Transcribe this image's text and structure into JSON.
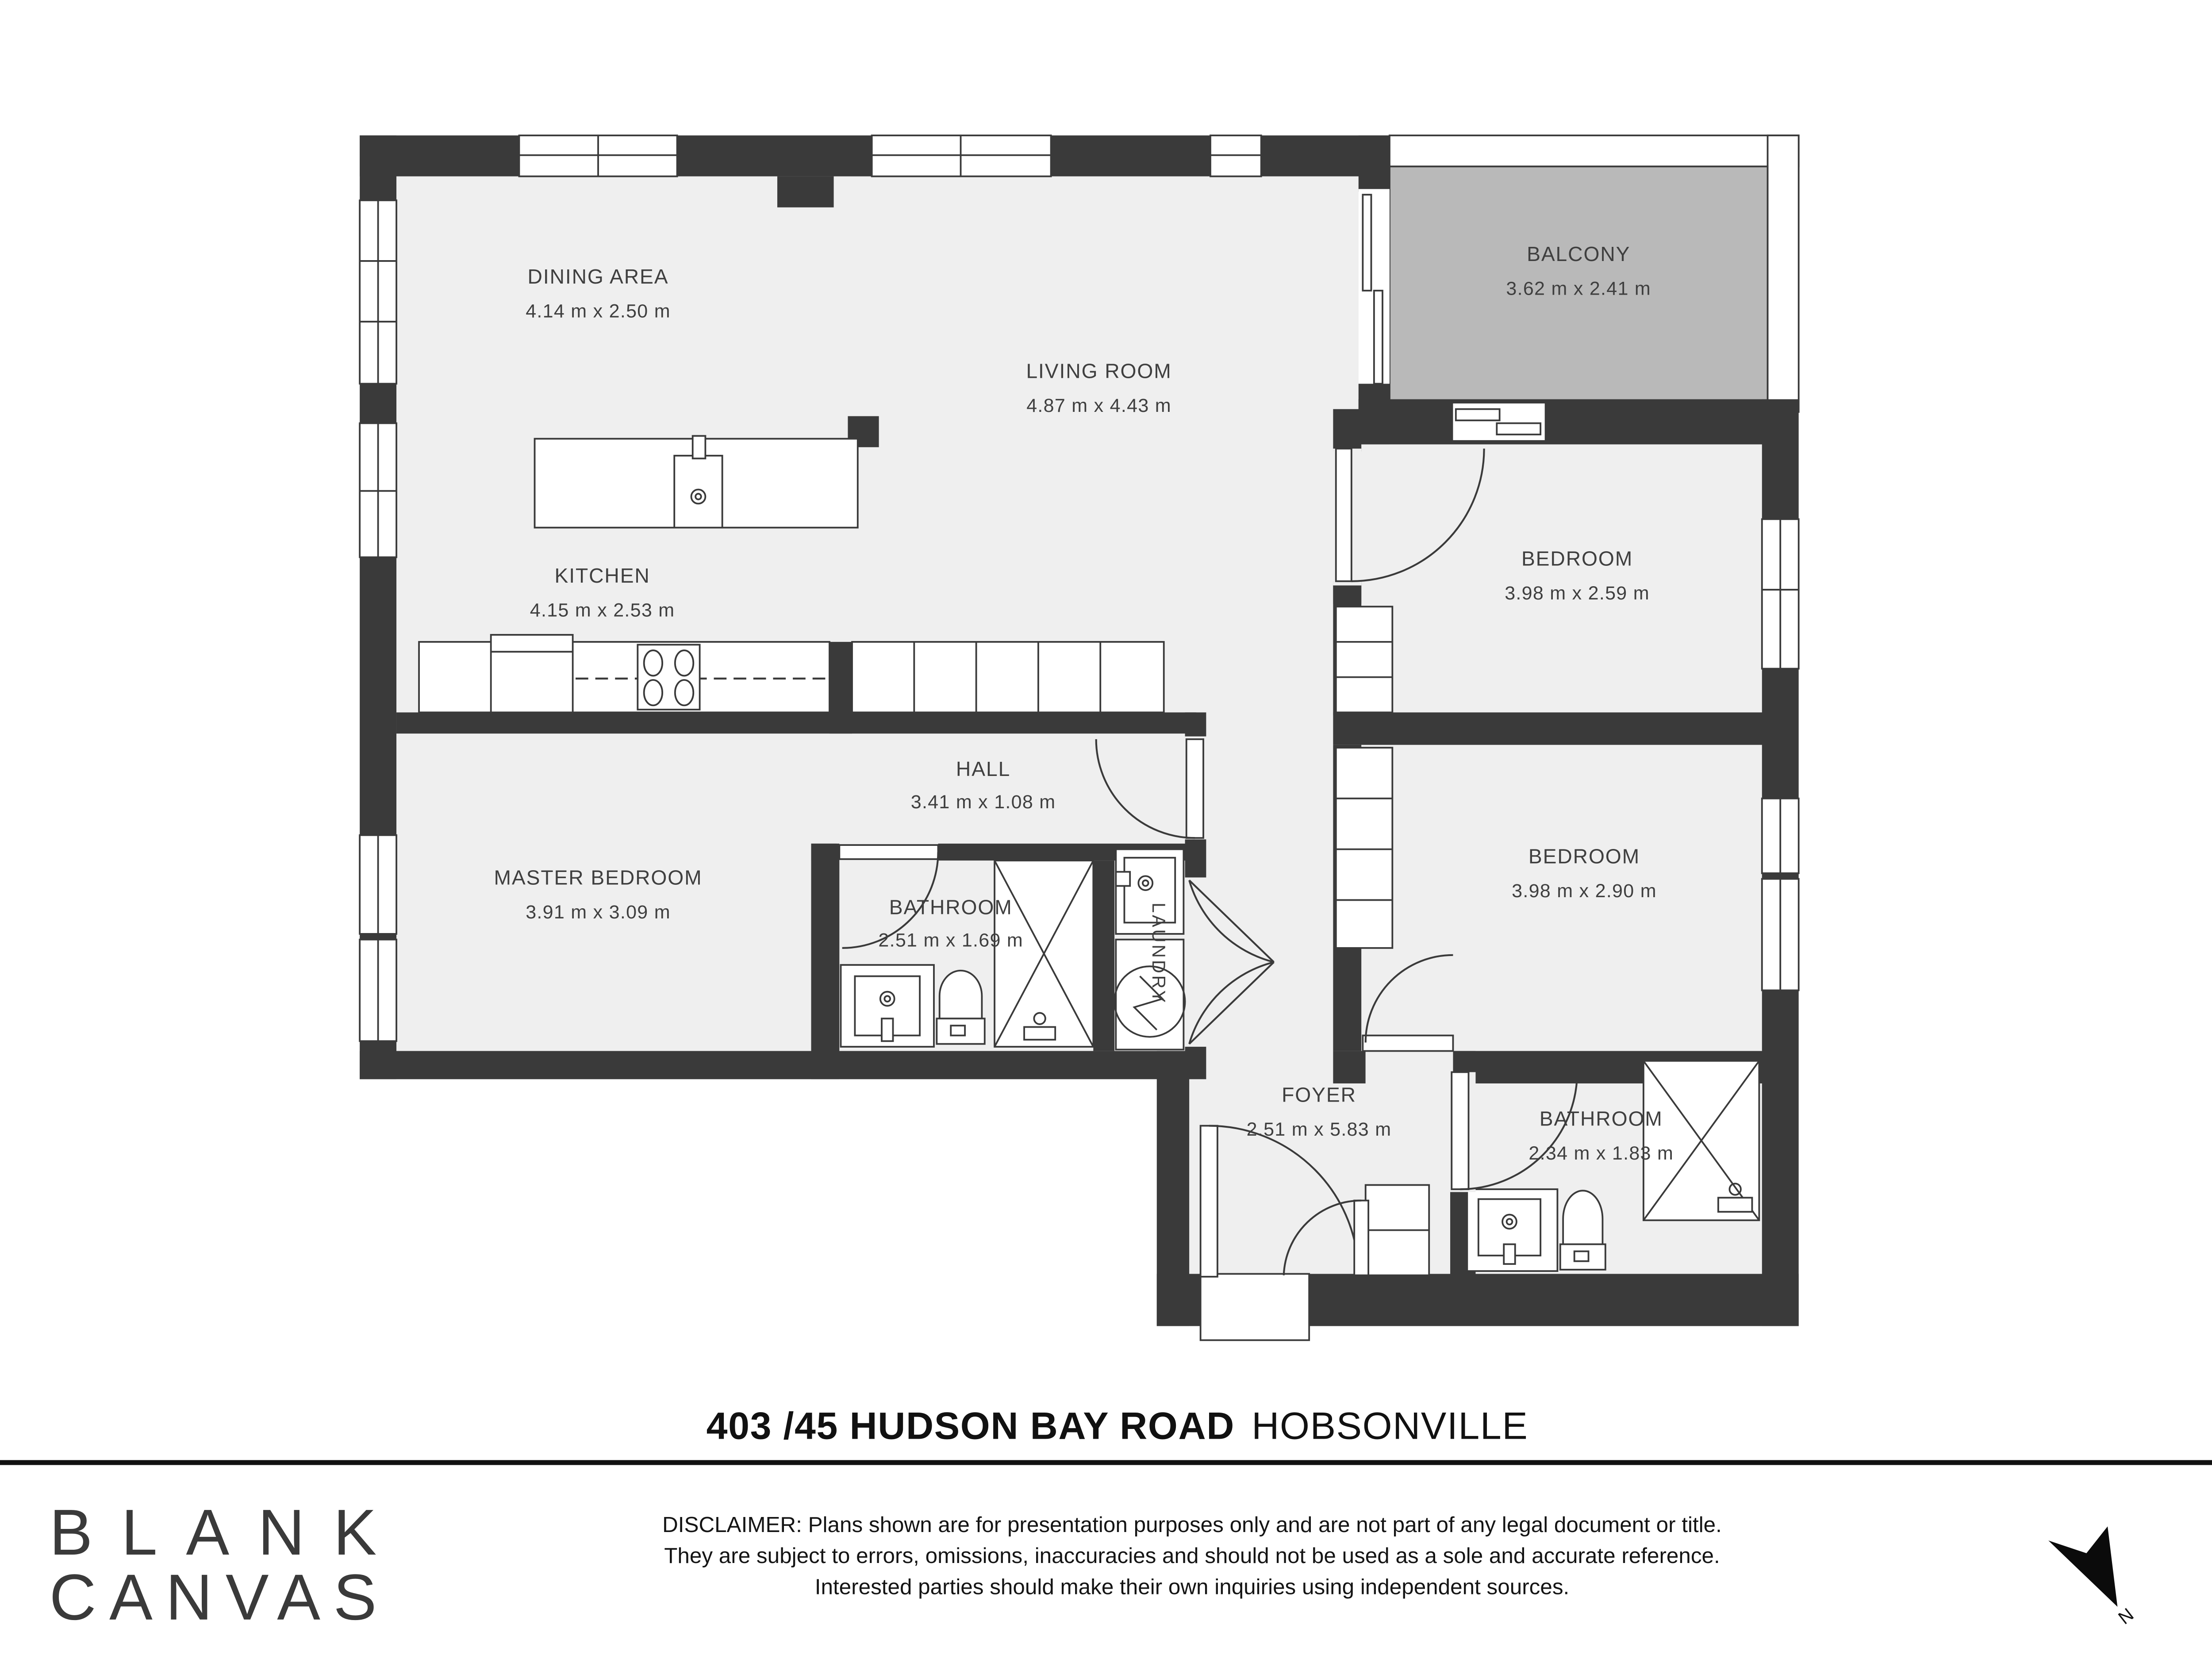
{
  "plan": {
    "colors": {
      "wall": "#3a3a3a",
      "floor": "#efefef",
      "balcony": "#b9b9b9",
      "line": "#3a3a3a",
      "label": "#3f3f3f"
    },
    "rooms": {
      "dining": {
        "name": "DINING AREA",
        "dims": "4.14 m x 2.50 m"
      },
      "living": {
        "name": "LIVING ROOM",
        "dims": "4.87 m x 4.43 m"
      },
      "kitchen": {
        "name": "KITCHEN",
        "dims": "4.15 m x 2.53 m"
      },
      "balcony": {
        "name": "BALCONY",
        "dims": "3.62 m x 2.41 m"
      },
      "bedroom1": {
        "name": "BEDROOM",
        "dims": "3.98 m x 2.59 m"
      },
      "bedroom2": {
        "name": "BEDROOM",
        "dims": "3.98 m x 2.90 m"
      },
      "master": {
        "name": "MASTER BEDROOM",
        "dims": "3.91 m x 3.09 m"
      },
      "hall": {
        "name": "HALL",
        "dims": "3.41 m x 1.08 m"
      },
      "bathroom1": {
        "name": "BATHROOM",
        "dims": "2.51 m x 1.69 m"
      },
      "bathroom2": {
        "name": "BATHROOM",
        "dims": "2.34 m x 1.83 m"
      },
      "laundry": {
        "name": "LAUNDRY"
      },
      "foyer": {
        "name": "FOYER",
        "dims": "2.51 m x 5.83 m"
      }
    },
    "compass": {
      "label": "N"
    }
  },
  "footer": {
    "address": {
      "main": "403 /45 HUDSON BAY ROAD",
      "suburb": "HOBSONVILLE"
    },
    "logo": {
      "line1": "BLANK",
      "line2": "CANVAS"
    },
    "disclaimer": {
      "line1": "DISCLAIMER: Plans shown are for presentation purposes only and are not part of any legal document or title.",
      "line2": "They are subject to errors, omissions, inaccuracies and should not be used as a sole and accurate reference.",
      "line3": "Interested parties should make their own inquiries using independent sources."
    }
  }
}
